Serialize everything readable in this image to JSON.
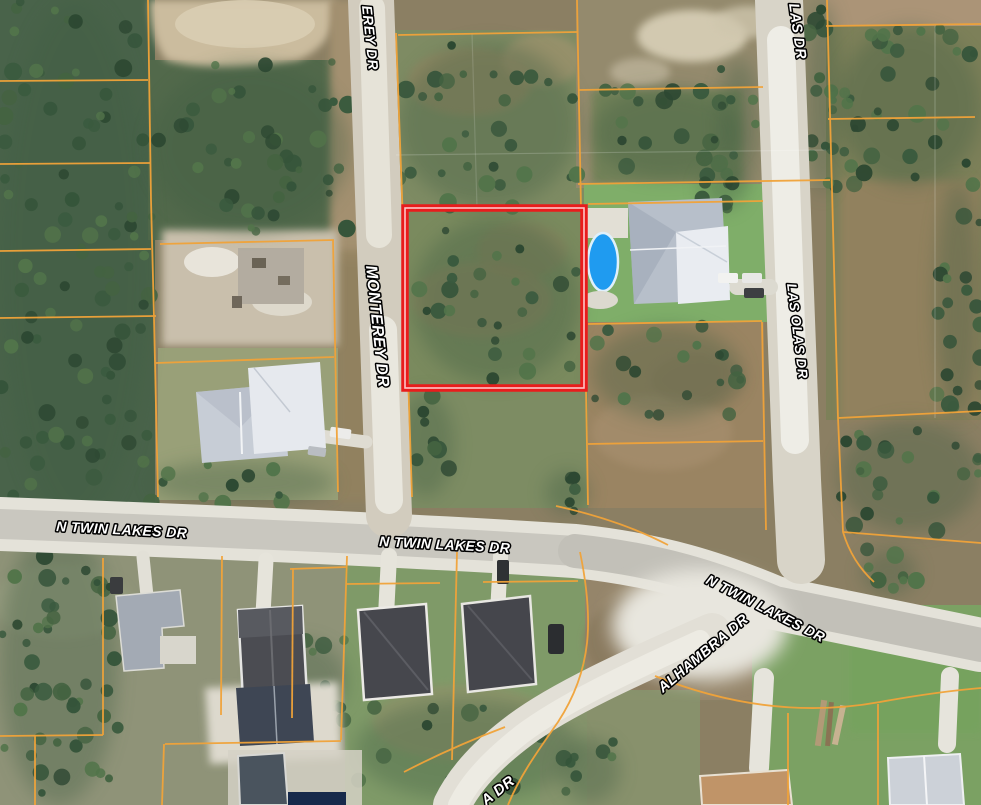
{
  "map": {
    "description": "satellite parcel map with highlighted lot",
    "selected_parcel": {
      "outline_color": "#e91c1c",
      "inner_line_color": "#ffc6c6"
    },
    "parcel_line_color": "#f1a339",
    "pool_color": "#1f9bf0",
    "label_style": {
      "fill": "#ffffff",
      "outline": "#000000"
    },
    "street_labels": [
      {
        "id": "monterey-dr-partial-top",
        "text": "EREY DR",
        "x": 362,
        "y": 6,
        "rotate": 84,
        "size": 14
      },
      {
        "id": "monterey-dr",
        "text": "MONTEREY DR",
        "x": 366,
        "y": 266,
        "rotate": 84,
        "size": 16
      },
      {
        "id": "las-olas-dr-partial-top",
        "text": "LAS DR",
        "x": 789,
        "y": 4,
        "rotate": 82,
        "size": 14.5
      },
      {
        "id": "las-olas-dr",
        "text": "LAS OLAS DR",
        "x": 787,
        "y": 284,
        "rotate": 83,
        "size": 13.5
      },
      {
        "id": "n-twin-lakes-dr-west",
        "text": "N TWIN LAKES DR",
        "x": 56,
        "y": 531,
        "rotate": 3,
        "size": 14
      },
      {
        "id": "n-twin-lakes-dr-center",
        "text": "N TWIN LAKES DR",
        "x": 379,
        "y": 546,
        "rotate": 3,
        "size": 14
      },
      {
        "id": "n-twin-lakes-dr-east",
        "text": "N TWIN LAKES DR",
        "x": 705,
        "y": 583,
        "rotate": 27,
        "size": 14
      },
      {
        "id": "alhambra-dr",
        "text": "ALHAMBRA DR",
        "x": 663,
        "y": 693,
        "rotate": -40,
        "size": 14.5
      },
      {
        "id": "alhambra-dr-partial-bottom",
        "text": "A DR",
        "x": 486,
        "y": 806,
        "rotate": -38,
        "size": 15
      }
    ]
  }
}
